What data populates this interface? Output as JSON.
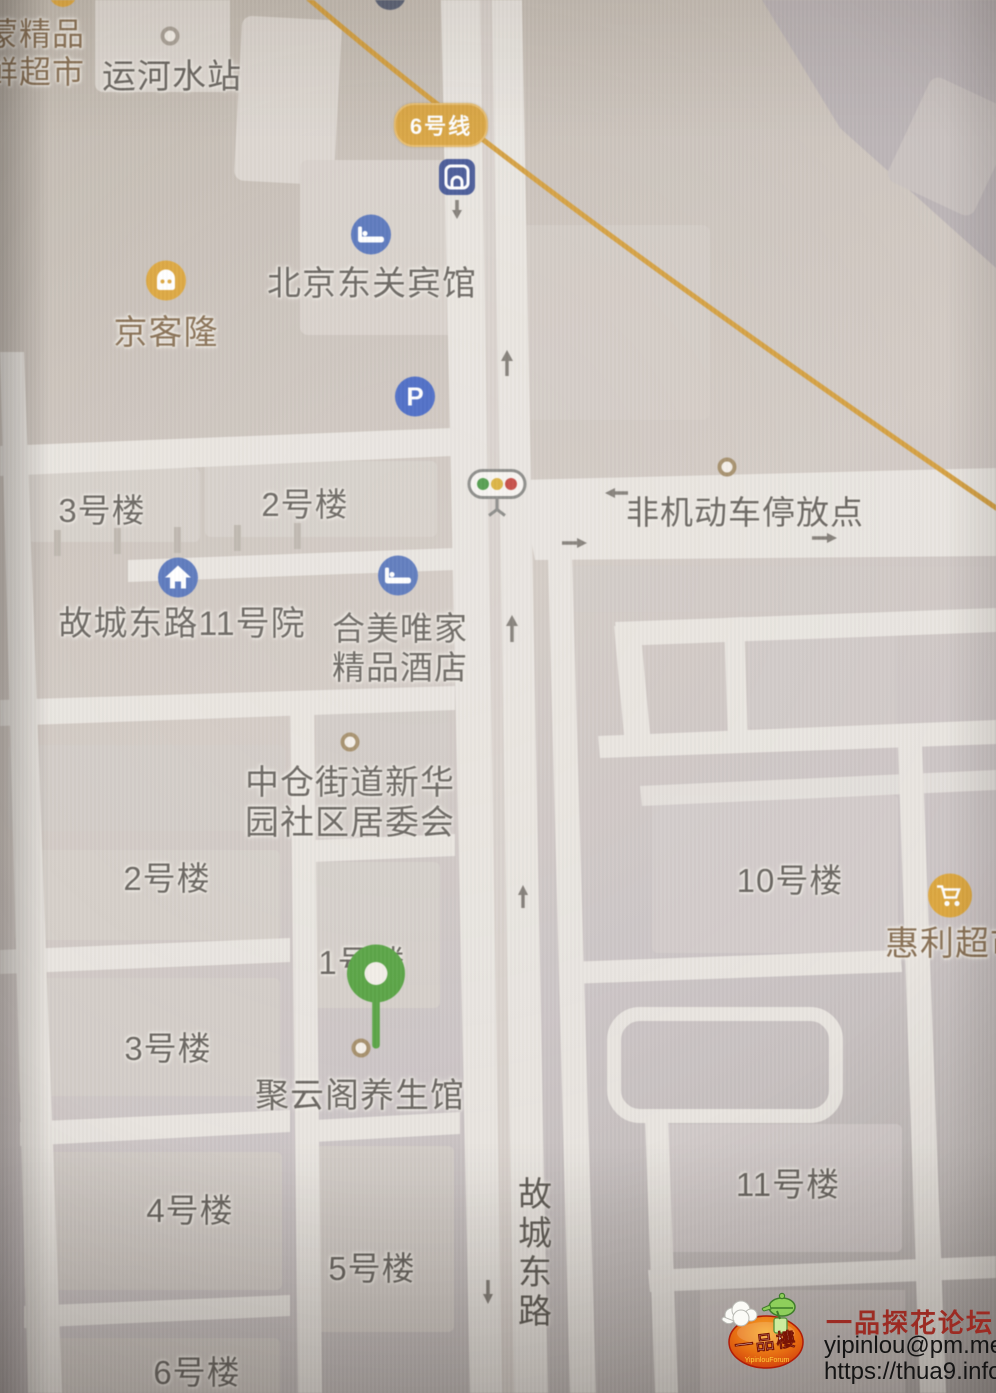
{
  "map": {
    "labels": {
      "supermarket_cut_line1": "蒙精品",
      "supermarket_cut_line2": "鲜超市",
      "yunhe_water_station": "运河水站",
      "subway_line6_badge": "6号线",
      "dongguan_hotel": "北京东关宾馆",
      "jingkelong": "京客隆",
      "building_3_upper": "3号楼",
      "building_2_upper": "2号楼",
      "gucheng_east_road_11_yard": "故城东路11号院",
      "hemei_hotel_line1": "合美唯家",
      "hemei_hotel_line2": "精品酒店",
      "non_motor_parking": "非机动车停放点",
      "committee_line1": "中仓街道新华",
      "committee_line2": "园社区居委会",
      "building_2_lower": "2号楼",
      "building_10": "10号楼",
      "huili_supermarket": "惠利超市",
      "building_1": "1号楼",
      "building_3_lower": "3号楼",
      "juyunge_wellness": "聚云阁养生馆",
      "building_4": "4号楼",
      "building_5": "5号楼",
      "building_11": "11号楼",
      "building_6": "6号楼",
      "street_vertical": "故城东路",
      "parking_letter": "P"
    },
    "colors": {
      "map_background": "#d0c9c3",
      "road": "#e9e5e0",
      "subway_line": "#d7a13e",
      "poi_blue": "#5b79c1",
      "poi_yellow": "#e0a83c",
      "pin_green": "#58a643",
      "label_gray": "#6b6762",
      "label_brown": "#8a7154"
    }
  },
  "watermark": {
    "logo_text": "一品樓",
    "logo_subtext": "YipinlouForum",
    "forum_name": "一品探花论坛",
    "email": "yipinlou@pm.me",
    "url": "https://thua9.info"
  }
}
